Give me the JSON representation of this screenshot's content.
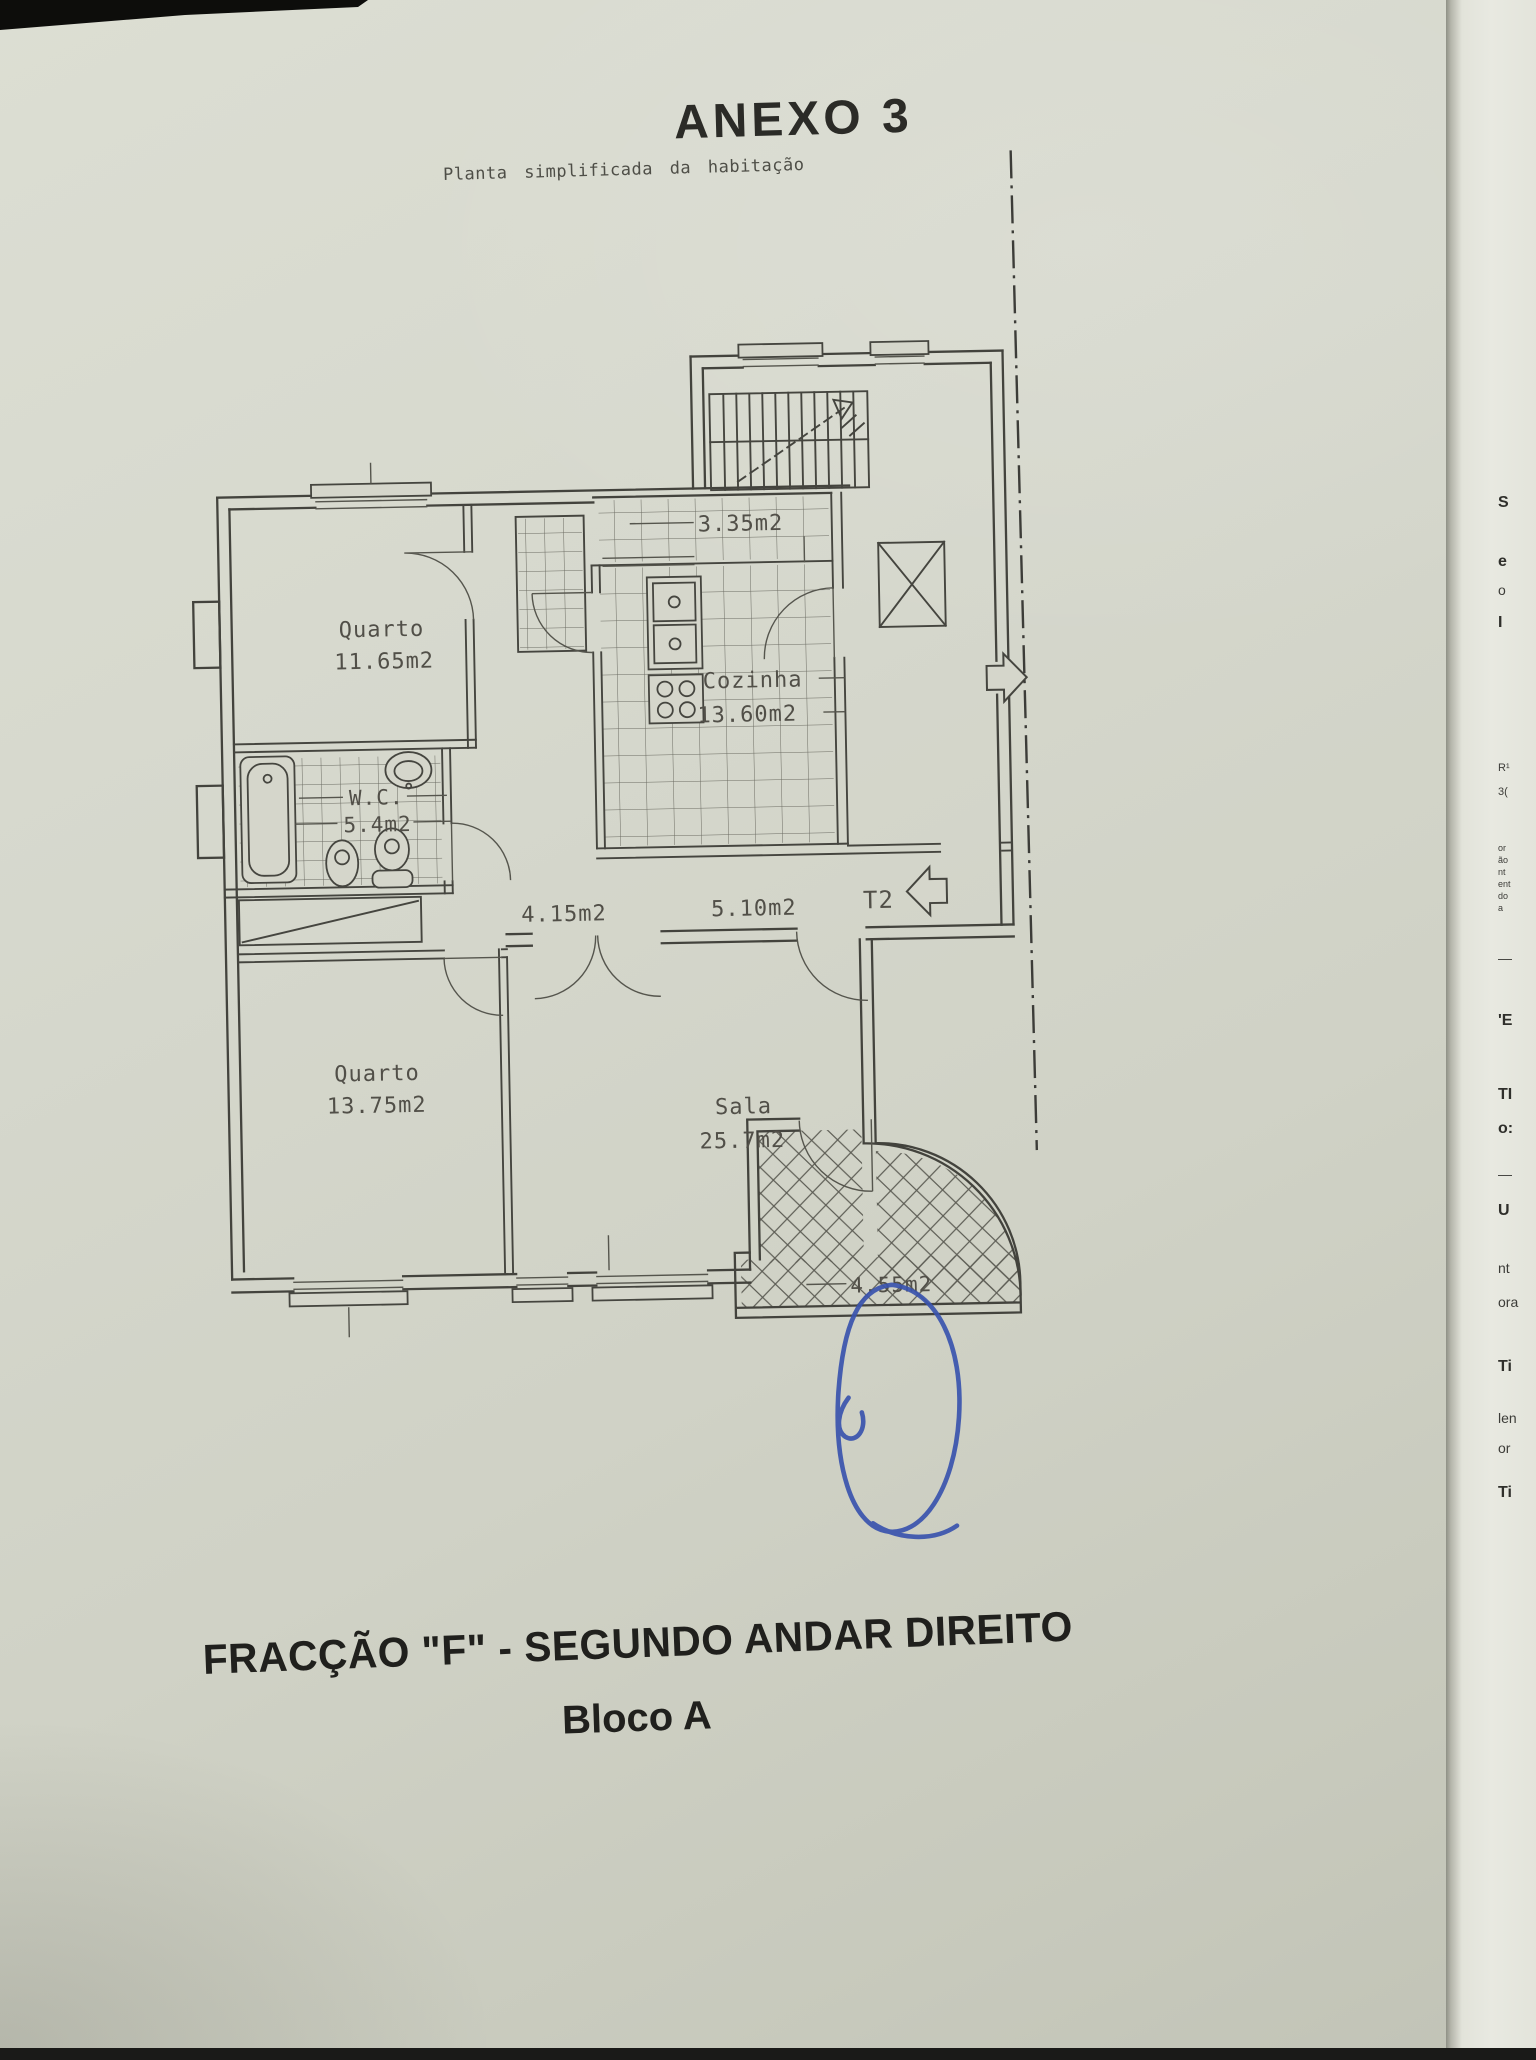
{
  "page": {
    "annex_title": "ANEXO  3",
    "subtitle": "Planta  simplificada  da  habitação",
    "footer_line1": "FRACÇÃO  \"F\" - SEGUNDO ANDAR DIREITO",
    "footer_line2": "Bloco A"
  },
  "plan": {
    "quarto1": {
      "name": "Quarto",
      "area": "11.65m2"
    },
    "wc": {
      "name": "W.C.",
      "area": "5.4m2"
    },
    "cozinha": {
      "name": "Cozinha",
      "area": "13.60m2"
    },
    "quarto2": {
      "name": "Quarto",
      "area": "13.75m2"
    },
    "sala": {
      "name": "Sala",
      "area": "25.7m2"
    },
    "balcony_top": {
      "area": "3.35m2"
    },
    "hall": {
      "area": "4.15m2"
    },
    "entry_hall": {
      "area": "5.10m2"
    },
    "balcony_bottom": {
      "area": "4.55m2"
    },
    "unit_type": "T2"
  },
  "colors": {
    "paper": "#d6d8cd",
    "ink": "#45453f",
    "heading_ink": "#20201d",
    "signature_blue": "#3a54ae",
    "under_page": "#e6e7df"
  },
  "edge_fragments": [
    {
      "y": 494,
      "t": "S",
      "b": 1
    },
    {
      "y": 553,
      "t": "e",
      "b": 1
    },
    {
      "y": 582,
      "t": "o",
      "b": 0
    },
    {
      "y": 614,
      "t": "I",
      "b": 1
    },
    {
      "y": 762,
      "t": "R¹",
      "b": 0,
      "s": 11
    },
    {
      "y": 786,
      "t": "3(",
      "b": 0,
      "s": 11
    },
    {
      "y": 843,
      "t": "or",
      "s": 9
    },
    {
      "y": 855,
      "t": "ão",
      "s": 9
    },
    {
      "y": 867,
      "t": "nt",
      "s": 9
    },
    {
      "y": 879,
      "t": "ent",
      "s": 9
    },
    {
      "y": 891,
      "t": "do",
      "s": 9
    },
    {
      "y": 903,
      "t": "a",
      "s": 9
    },
    {
      "y": 950,
      "t": "—",
      "b": 0
    },
    {
      "y": 1012,
      "t": "'E",
      "b": 1
    },
    {
      "y": 1086,
      "t": "TI",
      "b": 1
    },
    {
      "y": 1120,
      "t": "o:",
      "b": 1
    },
    {
      "y": 1166,
      "t": "—",
      "b": 0
    },
    {
      "y": 1202,
      "t": "U",
      "b": 1
    },
    {
      "y": 1260,
      "t": "nt",
      "b": 0
    },
    {
      "y": 1294,
      "t": "ora",
      "b": 0
    },
    {
      "y": 1358,
      "t": "Ti",
      "b": 1
    },
    {
      "y": 1410,
      "t": "len",
      "b": 0
    },
    {
      "y": 1440,
      "t": "or",
      "b": 0
    },
    {
      "y": 1484,
      "t": "Ti",
      "b": 1
    }
  ]
}
